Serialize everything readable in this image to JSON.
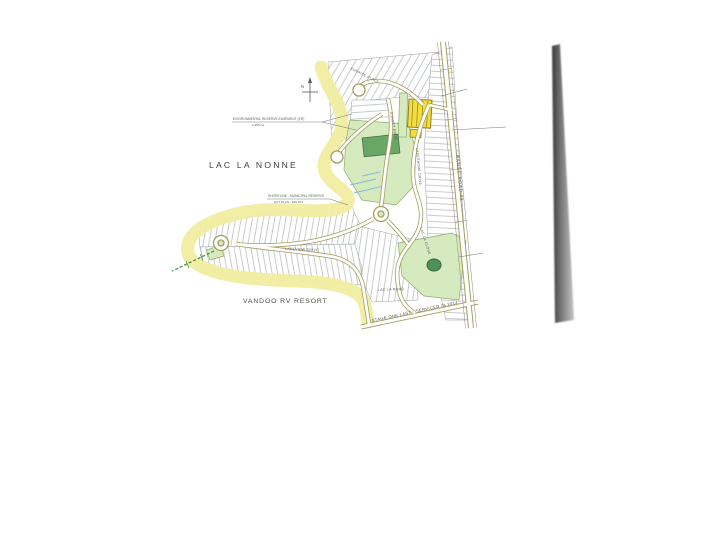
{
  "map": {
    "lake_label": "LAC LA NONNE",
    "resort_label": "VANDOO RV RESORT",
    "compass_letter": "N",
    "annotations": {
      "env_reserve_line1": "ENVIRONMENTAL RESERVE EASEMENT (ER)",
      "env_reserve_line2": "2.995 ha",
      "shore_note_line1": "SHORELINE - MUNICIPAL RESERVE",
      "shore_note_line2": "ACT PLAN - 645 974"
    },
    "streets": {
      "range_road": "RANGE ROAD 32",
      "sunrise_place": "SUNRISE PLACE",
      "sunset_drive": "SUNSET DRIVE",
      "lakeshore_drive": "LAKESHORE DRIVE",
      "lac_la_close": "LAC LA CLOSE",
      "lakeview_drive": "LAKEVIEW DRIVE",
      "lac_la_road": "LAC LA ROAD",
      "stage_note": "STAGE ONE LAST - SERVICED IN 2014"
    },
    "colors": {
      "shore_band": "#f1eda1",
      "highlight_lot": "#f2df3d",
      "park_green": "#d6eabf",
      "deep_green": "#68a766",
      "pond_green": "#4f9156",
      "road_casing": "#a49f5e",
      "scan_band_dark": "#3a3a3a",
      "scan_band_light": "#c6c6c6"
    }
  }
}
